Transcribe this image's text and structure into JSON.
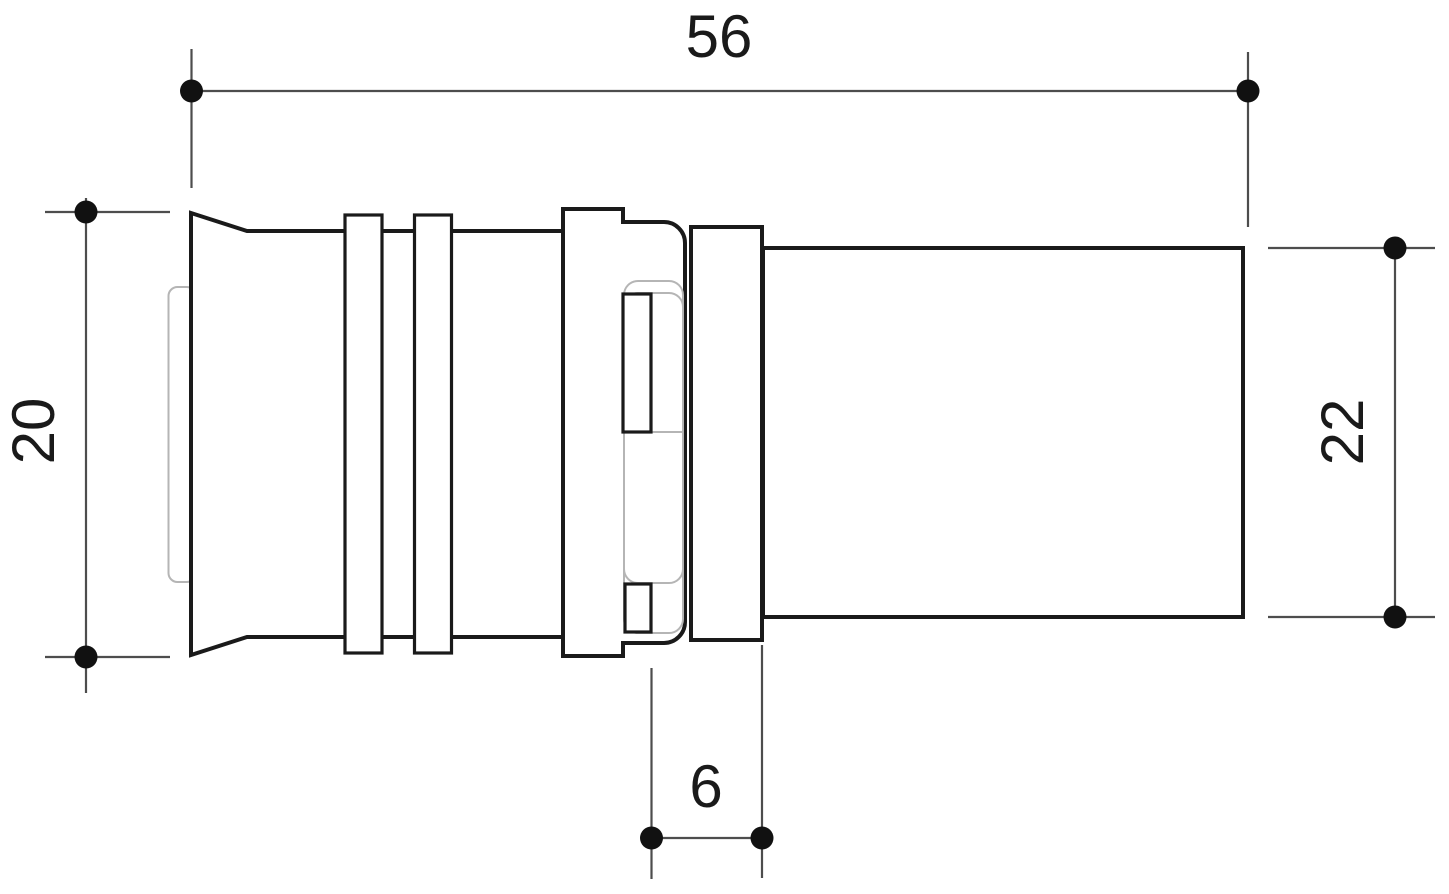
{
  "colors": {
    "background": "#ffffff",
    "outline": "#1a1a1a",
    "detail": "#b5b5b5",
    "dimension": "#4d4d4d",
    "marker": "#111111",
    "text": "#1a1a1a"
  },
  "dimensions": {
    "overall_length": {
      "label": "56",
      "orientation": "horizontal",
      "position": "top"
    },
    "left_diameter": {
      "label": "20",
      "orientation": "vertical",
      "position": "left"
    },
    "right_diameter": {
      "label": "22",
      "orientation": "vertical",
      "position": "right"
    },
    "collar_width": {
      "label": "6",
      "orientation": "horizontal",
      "position": "bottom"
    }
  }
}
